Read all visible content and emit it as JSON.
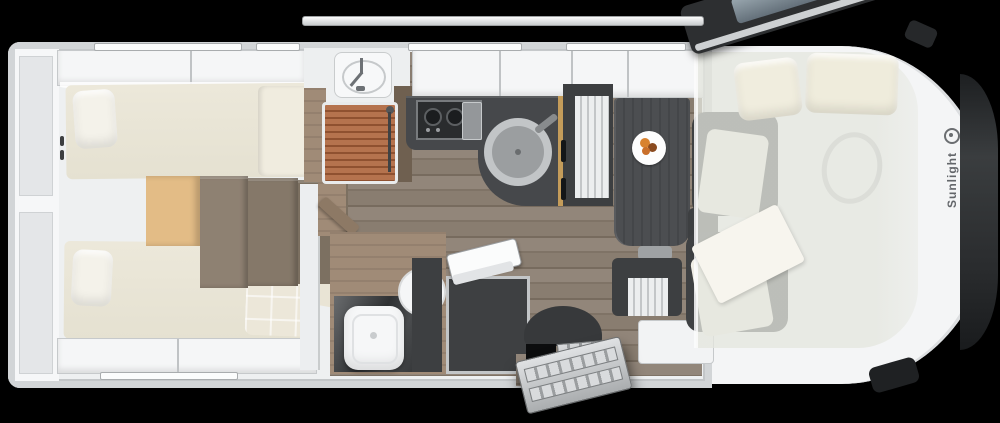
{
  "brand": {
    "label": "Sunlight",
    "logo": "ring-mark"
  },
  "icons": {
    "faucet-icon": "css-shape",
    "shower-head-icon": "css-circle",
    "food-plate-icon": "css-circle-with-food-dots",
    "brand-logo-icon": "ring",
    "grab-handle-icon": "double-bar"
  },
  "colors": {
    "bg": "#000000",
    "body": "#f4f5f6",
    "wall": "#d2d5d7",
    "interior": "#eef0f1",
    "bed": "#eae6d7",
    "pillow": "#f4f2ea",
    "light-wood": "#e3bc86",
    "step-wood": "#877a6b",
    "floor": "#8b7f72",
    "counter": "#46484b",
    "hob": "#2a2c2e",
    "sink-metal": "#9b9ea0",
    "shower-slat": "#b5734e",
    "wood-wall": "#a08b77",
    "gold-trim": "#c49c5a",
    "furniture-dark": "#3d3f41",
    "glass": "#8b99a1",
    "door-dark": "#2d2f31",
    "metal-step": "#c6c9cb",
    "drop-bed-overlay": "rgba(228,230,222,0.76)",
    "brand-text": "#63666a",
    "food-orange": "#d8822f"
  }
}
